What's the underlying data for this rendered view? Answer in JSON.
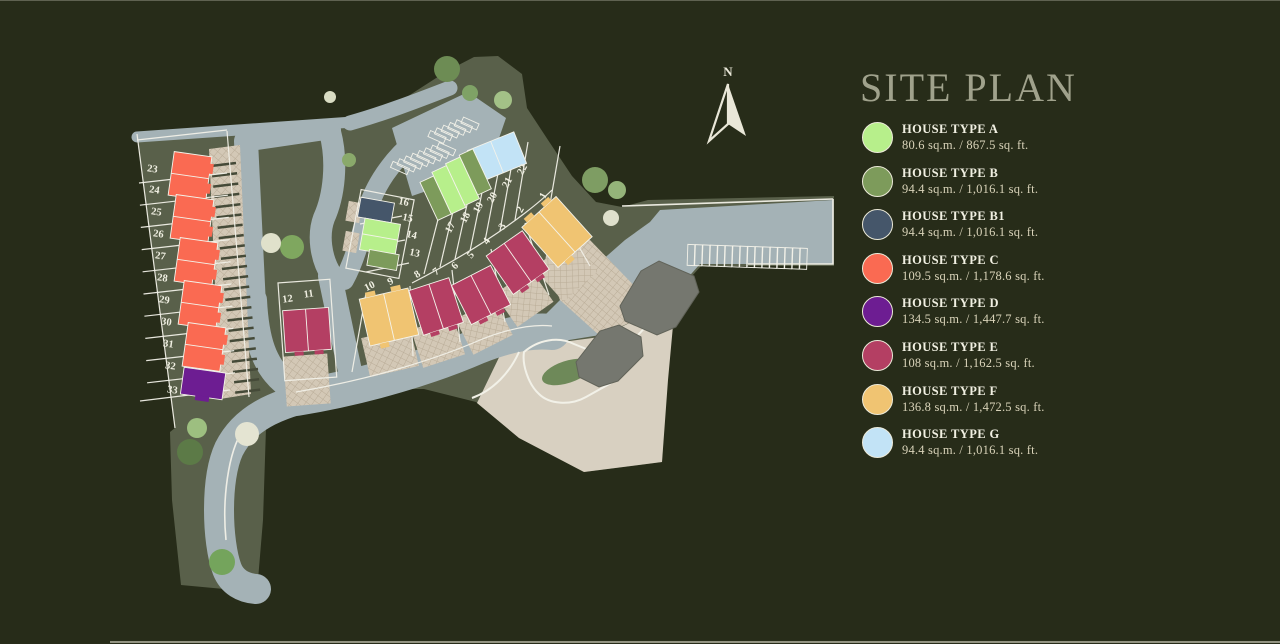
{
  "title": "SITE PLAN",
  "compass": {
    "label": "N"
  },
  "legend": [
    {
      "type": "HOUSE TYPE A",
      "size": "80.6 sq.m. / 867.5 sq. ft.",
      "color": "#b7ef8b"
    },
    {
      "type": "HOUSE TYPE B",
      "size": "94.4 sq.m. / 1,016.1 sq. ft.",
      "color": "#7d9b5b"
    },
    {
      "type": "HOUSE TYPE B1",
      "size": "94.4 sq.m. / 1,016.1 sq. ft.",
      "color": "#45566a"
    },
    {
      "type": "HOUSE TYPE C",
      "size": "109.5 sq.m. / 1,178.6 sq. ft.",
      "color": "#fa6a52"
    },
    {
      "type": "HOUSE TYPE D",
      "size": "134.5 sq.m. / 1,447.7 sq. ft.",
      "color": "#6d1d92"
    },
    {
      "type": "HOUSE TYPE E",
      "size": "108 sq.m. / 1,162.5 sq. ft.",
      "color": "#b43f63"
    },
    {
      "type": "HOUSE TYPE F",
      "size": "136.8 sq.m. / 1,472.5 sq. ft.",
      "color": "#f0c472"
    },
    {
      "type": "HOUSE TYPE G",
      "size": "94.4 sq.m. / 1,016.1 sq. ft.",
      "color": "#c2e3f6"
    }
  ],
  "map": {
    "lot_numbers": [
      "1",
      "2",
      "3",
      "4",
      "5",
      "6",
      "7",
      "8",
      "9",
      "10",
      "11",
      "12",
      "13",
      "14",
      "15",
      "16",
      "17",
      "18",
      "19",
      "20",
      "21",
      "22",
      "23",
      "24",
      "25",
      "26",
      "27",
      "28",
      "29",
      "30",
      "31",
      "32",
      "33"
    ]
  }
}
